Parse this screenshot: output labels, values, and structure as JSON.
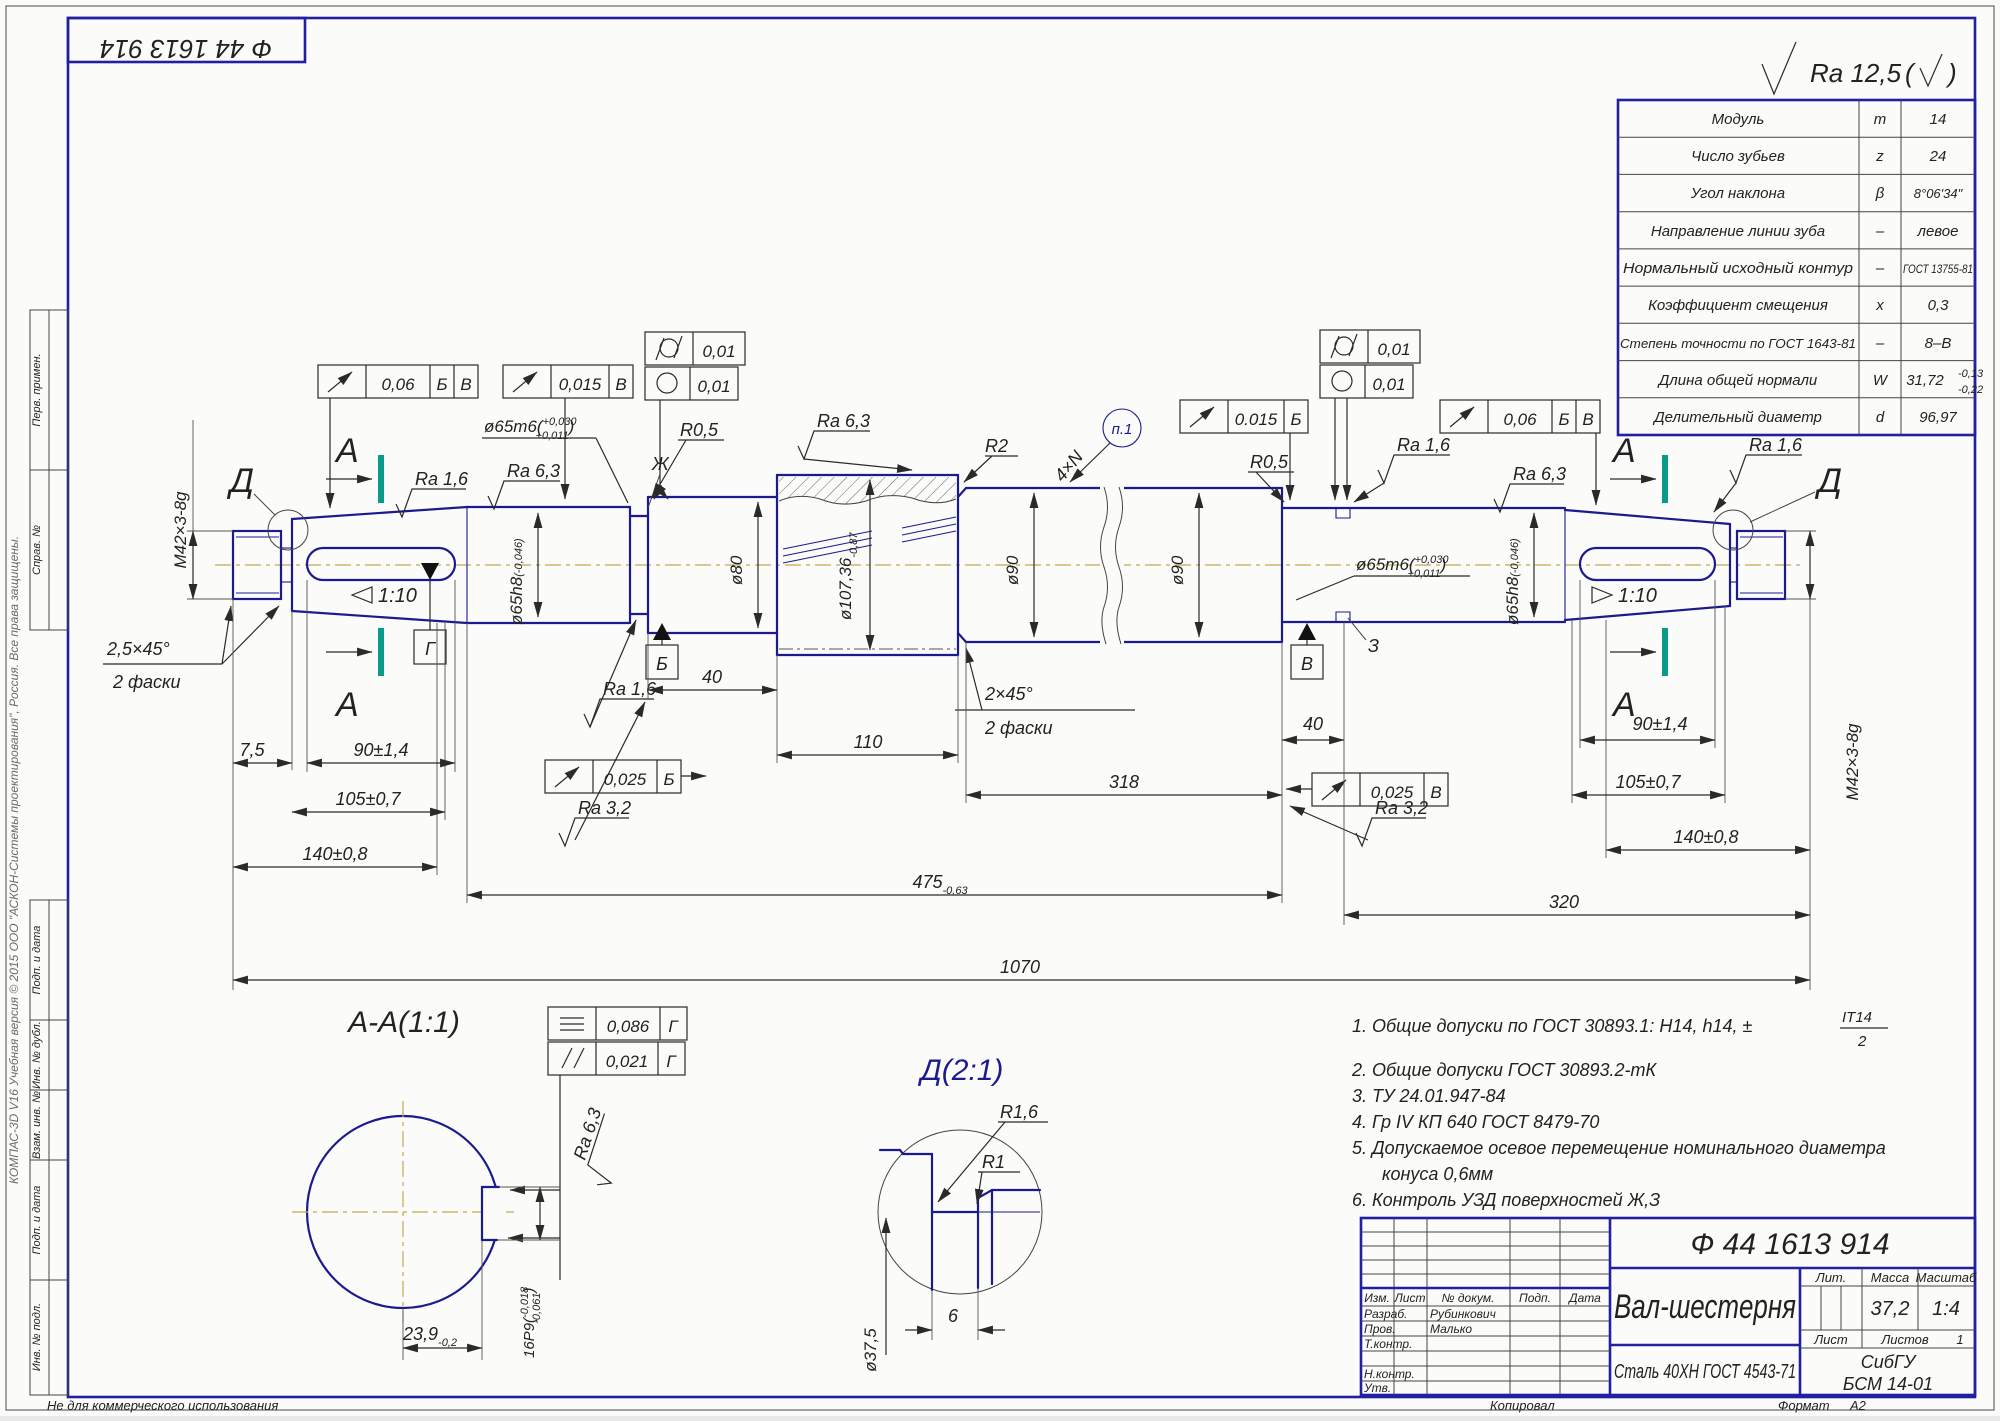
{
  "stamp": {
    "code": "Ф 44 1613 914"
  },
  "surface_general": {
    "ra": "Ra 12,5",
    "paren_open": "(",
    "paren_close": ")"
  },
  "margin": {
    "labels": [
      "Перв. примен.",
      "Справ. №",
      "Подп. и дата",
      "Инв. № дубл.",
      "Взам. инв. №",
      "Подп. и дата",
      "Инв. № подл."
    ],
    "watermark": "КОМПАС-3D V16 Учебная версия © 2015 ООО \"АСКОН-Системы проектирования\", Россия. Все права защищены.",
    "not_for_commercial": "Не для коммерческого использования"
  },
  "gear_table": {
    "rows": [
      {
        "name": "Модуль",
        "sym": "m",
        "val": "14"
      },
      {
        "name": "Число зубьев",
        "sym": "z",
        "val": "24"
      },
      {
        "name": "Угол наклона",
        "sym": "β",
        "val": "8°06'34\""
      },
      {
        "name": "Направление линии зуба",
        "sym": "–",
        "val": "левое"
      },
      {
        "name": "Нормальный исходный контур",
        "sym": "–",
        "val": "ГОСТ 13755-81"
      },
      {
        "name": "Коэффициент смещения",
        "sym": "x",
        "val": "0,3"
      },
      {
        "name": "Степень точности по ГОСТ 1643-81",
        "sym": "–",
        "val": "8–В"
      },
      {
        "name": "Длина общей нормали",
        "sym": "W",
        "val": "31,72"
      },
      {
        "name": "Делительный диаметр",
        "sym": "d",
        "val": "96,97"
      }
    ],
    "w_upper": "-0,13",
    "w_lower": "-0,22"
  },
  "view": {
    "letters": {
      "a": "А",
      "d": "Д",
      "b": "Б",
      "v": "В",
      "g": "Г",
      "zh": "Ж",
      "ze": "З"
    },
    "m42": "M42×3-8g",
    "chamfer25": "2,5×45°",
    "chamfer2": "2 фаски",
    "chamfer20": "2×45°",
    "taper": "1:10",
    "d65m6": "ø65m6(",
    "d65m6_sup": "+0,030",
    "d65m6_sub": "+0,011",
    "d65m6_close": ")",
    "d65h8": "ø65h8",
    "d65h8_tol": "(-0,046)",
    "d80": "ø80",
    "d90": "ø90",
    "d107": "ø107,36",
    "d107_tol": "-0,87",
    "r2": "R2",
    "r05": "R0,5",
    "ra16": "Ra 1,6",
    "ra63": "Ra 6,3",
    "ra32": "Ra 3,2",
    "n4": "4×N",
    "p1": "п.1",
    "dim75": "7,5",
    "dim90": "90±1,4",
    "dim105": "105±0,7",
    "dim140": "140±0,8",
    "dim40": "40",
    "dim110": "110",
    "dim318": "318",
    "dim475": "475",
    "dim475_tol": "-0,63",
    "dim320": "320",
    "dim1070": "1070"
  },
  "frames": {
    "runout006": "0,06",
    "runout0015": "0,015",
    "runout0015r": "0.015",
    "cyl001": "0,01",
    "round001": "0,01",
    "par0025": "0,025",
    "sym0086": "0,086",
    "par0021": "0,021"
  },
  "section_aa": {
    "title": "А-А(1:1)",
    "dim239": "23,9",
    "dim239_tol": "-0,2",
    "key": "16P9(",
    "key_sup": "-0,018",
    "key_sub": "-0,061",
    "key_close": ")",
    "ra63": "Ra 6,3"
  },
  "detail_d": {
    "title": "Д(2:1)",
    "r16": "R1,6",
    "r1": "R1",
    "d375": "ø37,5",
    "width": "6"
  },
  "notes": {
    "n1": "1. Общие допуски по ГОСТ 30893.1: H14, h14, ±",
    "n1_top": "IT14",
    "n1_bot": "2",
    "n2": "2. Общие допуски ГОСТ 30893.2-тК",
    "n3": "3. ТУ 24.01.947-84",
    "n4": "4. Гр IV КП 640 ГОСТ 8479-70",
    "n5": "5. Допускаемое осевое перемещение номинального диаметра",
    "n5b": "конуса 0,6мм",
    "n6": "6. Контроль УЗД поверхностей Ж,З"
  },
  "title_block": {
    "doc": "Ф 44 1613 914",
    "name": "Вал-шестерня",
    "material": "Сталь 40ХН ГОСТ 4543-71",
    "header": [
      "Изм.",
      "Лист",
      "№ докум.",
      "Подп.",
      "Дата"
    ],
    "r1l": "Разраб.",
    "r1v": "Рубинкович",
    "r2l": "Пров.",
    "r2v": "Малько",
    "r3l": "Т.контр.",
    "r4l": "Н.контр.",
    "r5l": "Утв.",
    "lit": "Лит.",
    "mass": "Масса",
    "scale": "Масштаб",
    "mass_v": "37,2",
    "scale_v": "1:4",
    "sheet": "Лист",
    "sheets": "Листов",
    "sheets_v": "1",
    "org": "СибГУ",
    "org2": "БСМ 14-01",
    "copied": "Копировал",
    "format": "Формат",
    "format_v": "А2"
  }
}
